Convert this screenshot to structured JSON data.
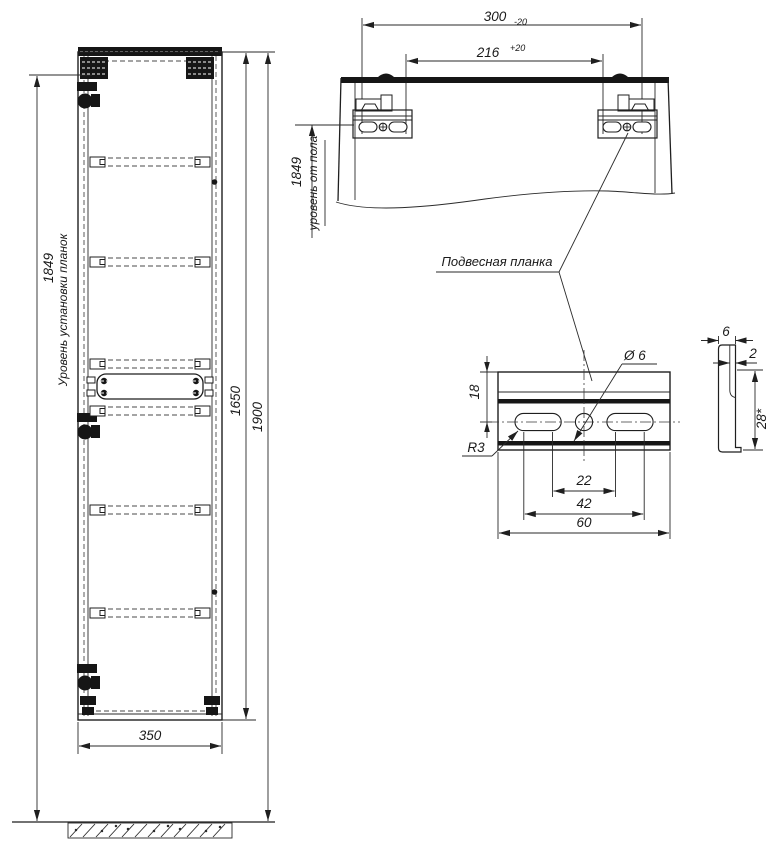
{
  "front_view": {
    "plank_level_dim": "1849",
    "plank_level_label": "Уровень установки планок",
    "cabinet_height_dim": "1650",
    "total_height_dim": "1900",
    "width_dim": "350"
  },
  "top_view": {
    "outer_span_dim": "300",
    "outer_span_tolerance": "-20",
    "inner_span_dim": "216",
    "inner_span_tolerance": "+20",
    "floor_level_dim": "1849",
    "floor_level_label": "уровень от пола"
  },
  "callout": {
    "plank_label": "Подвесная планка"
  },
  "plank_front_detail": {
    "edge_to_holes_dim": "18",
    "hole_diameter": "Ø 6",
    "slot_radius": "R3",
    "inner_spacing_dim": "22",
    "outer_spacing_dim": "42",
    "width_dim": "60"
  },
  "plank_side_detail": {
    "width_dim": "6",
    "thickness_dim": "2",
    "height_dim": "28*"
  }
}
